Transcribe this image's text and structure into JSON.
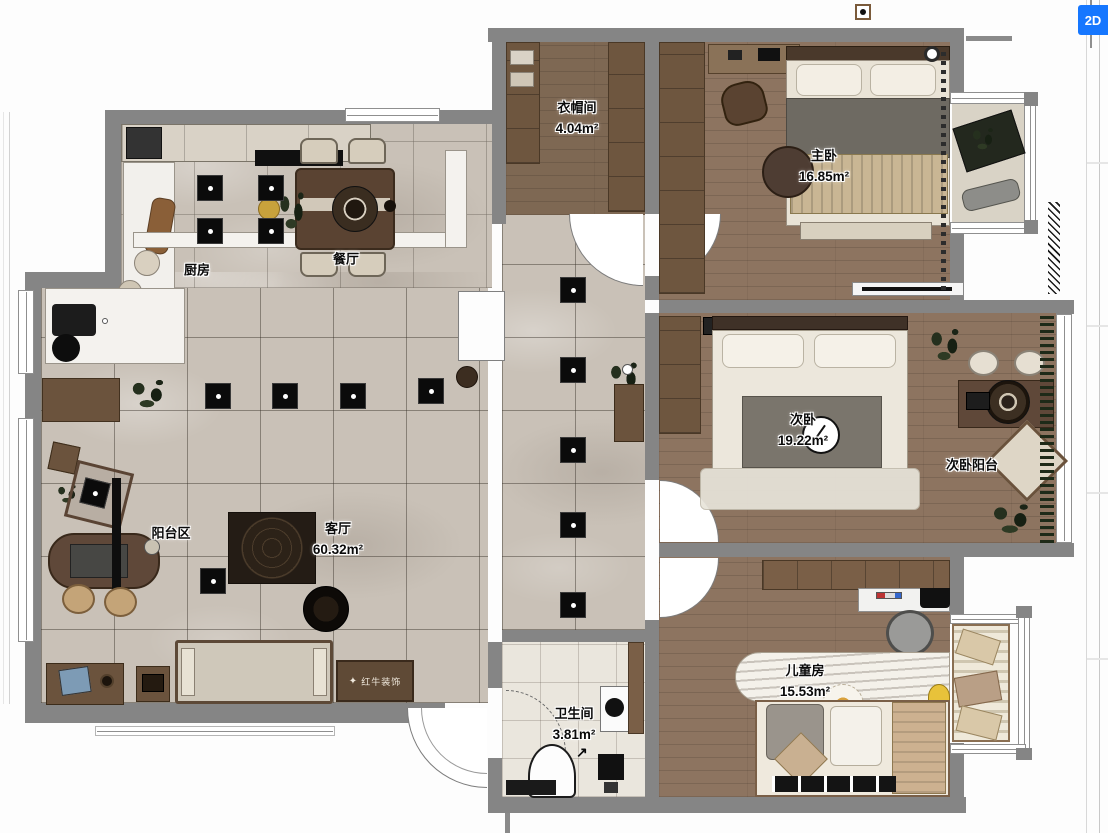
{
  "app": {
    "view_button": "2D"
  },
  "rooms": [
    {
      "id": "cloakroom",
      "name": "衣帽间",
      "area": "4.04m²"
    },
    {
      "id": "master-bedroom",
      "name": "主卧",
      "area": "16.85m²"
    },
    {
      "id": "kitchen",
      "name": "厨房",
      "area": ""
    },
    {
      "id": "dining",
      "name": "餐厅",
      "area": ""
    },
    {
      "id": "second-bedroom",
      "name": "次卧",
      "area": "19.22m²"
    },
    {
      "id": "second-balcony",
      "name": "次卧阳台",
      "area": ""
    },
    {
      "id": "balcony-zone",
      "name": "阳台区",
      "area": ""
    },
    {
      "id": "living-room",
      "name": "客厅",
      "area": "60.32m²"
    },
    {
      "id": "kids-room",
      "name": "儿童房",
      "area": "15.53m²"
    },
    {
      "id": "bathroom",
      "name": "卫生间",
      "area": "3.81m²"
    }
  ],
  "watermark": {
    "brand": "红牛装饰"
  },
  "colors": {
    "wall": "#858585",
    "marble": "#c9c1b7",
    "wood": "#8d7460",
    "accent": "#1677ff"
  }
}
